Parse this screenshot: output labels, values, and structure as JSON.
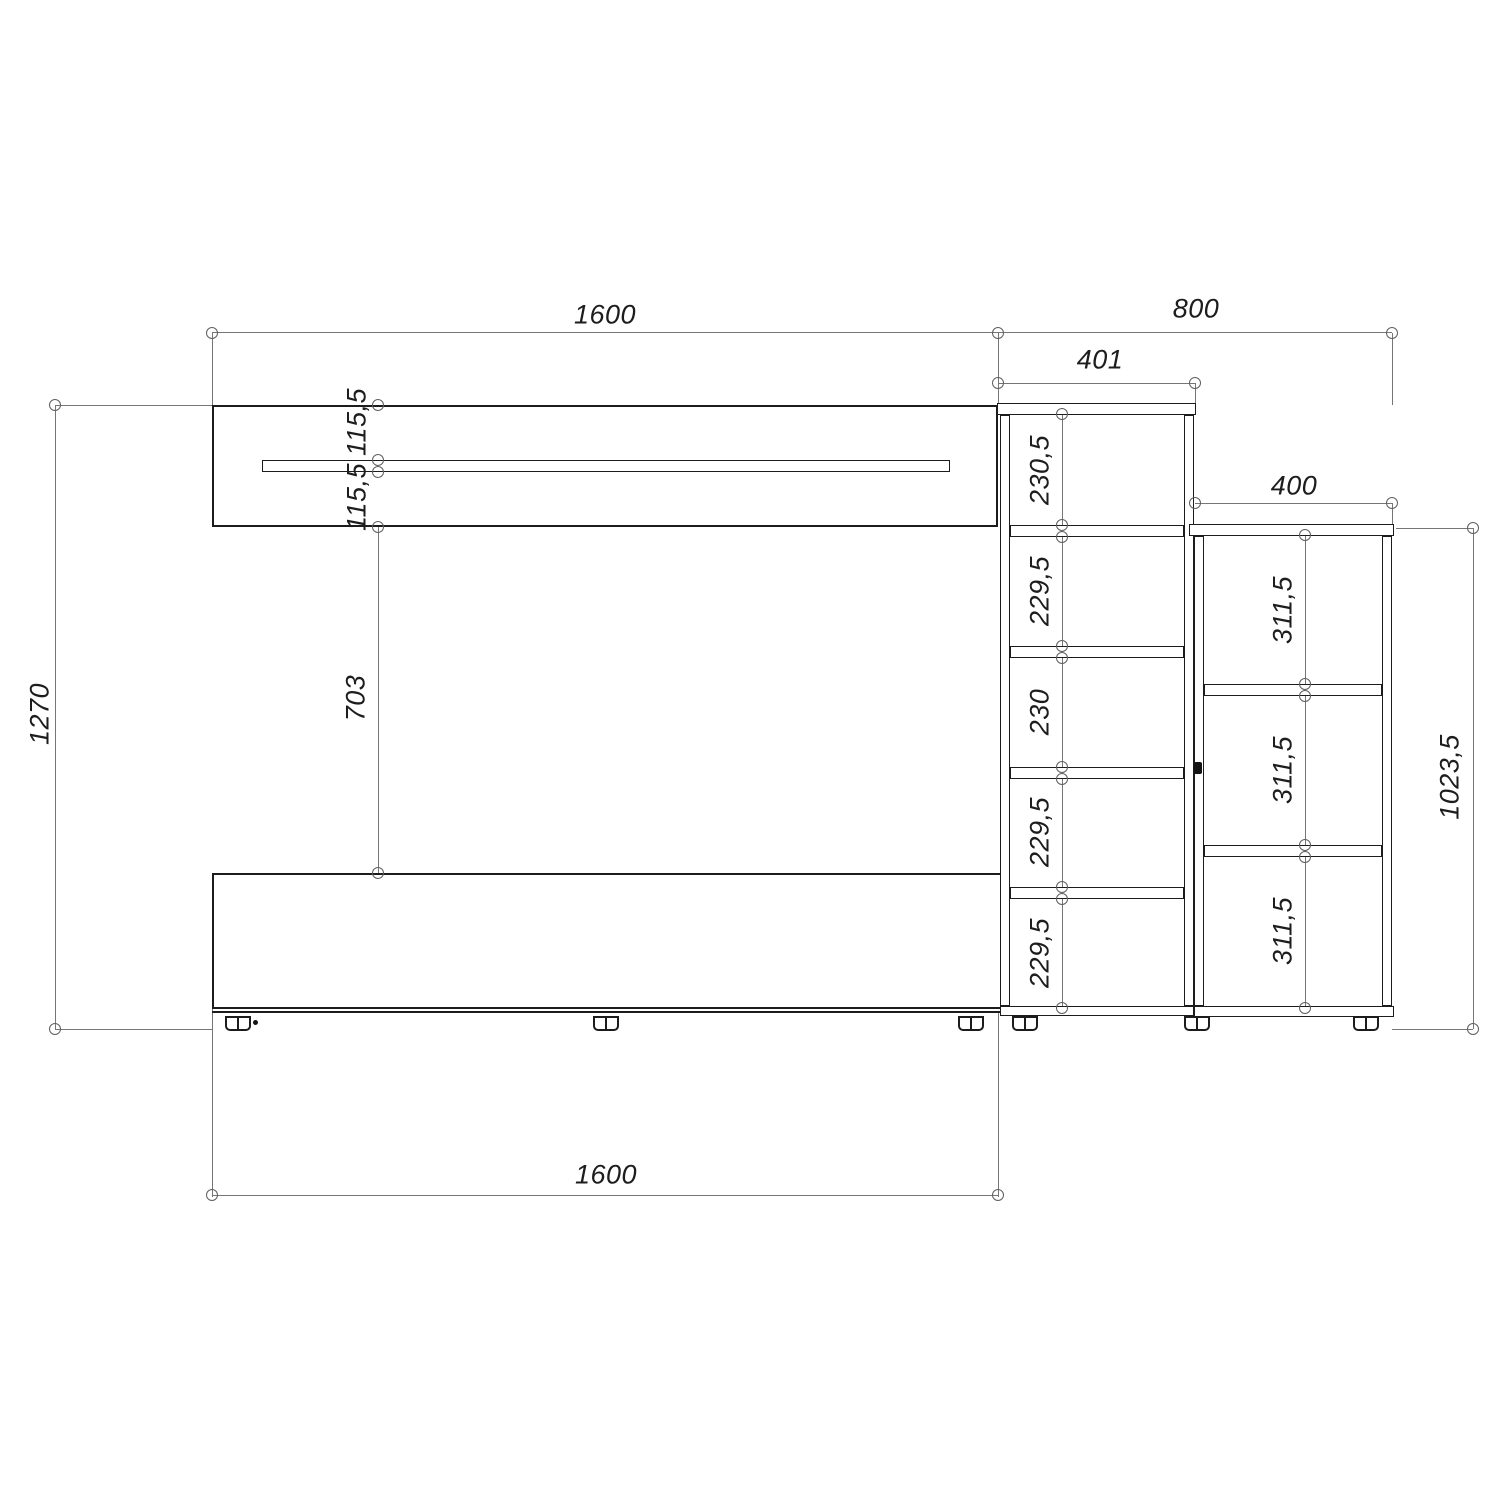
{
  "drawing": {
    "description": "Dimensioned front-view technical drawing of a living-room wall unit: hanging shelf, TV cabinet, tall five-cell shelf column and low three-cell side unit",
    "units_note": "",
    "colors": {
      "background": "#ffffff",
      "object_line": "#1c1c1c",
      "dimension_line": "#767676",
      "text": "#1d1d1d"
    },
    "labels": {
      "top_width": "1600",
      "top_right_width": "800",
      "tall_unit_width": "401",
      "side_unit_width": "400",
      "total_height": "1270",
      "upper_gap_1": "115,5",
      "upper_gap_2": "115,5",
      "mid_gap": "703",
      "bottom_width": "1600",
      "side_unit_height": "1023,5",
      "center_cells": [
        "230,5",
        "229,5",
        "230",
        "229,5",
        "229,5"
      ],
      "right_cells": [
        "311,5",
        "311,5",
        "311,5"
      ]
    }
  }
}
